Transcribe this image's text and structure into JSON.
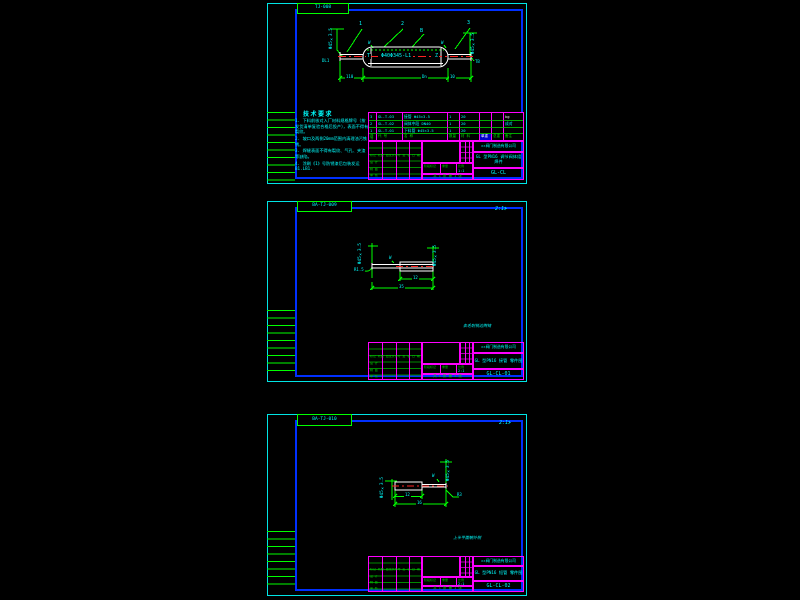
{
  "colors": {
    "background": "#000000",
    "border_outer_cyan": "#00e5e5",
    "border_inner_blue": "#0030ff",
    "frame_green": "#00ff00",
    "grid_magenta": "#ff00ff",
    "text_cyan": "#00ffff",
    "geometry_white": "#ffffff",
    "centerline_red": "#ff2222",
    "highlight_blue": "#0000cc"
  },
  "common": {
    "company": "××阀门制造有限公司",
    "mark_row": "标记 处数 更改文件号 签 名 日 期",
    "design_label": "设 计",
    "draft_label": "制 图",
    "check_label": "审 核",
    "stage_label": "阶段标记",
    "weight_label": "重量",
    "scale_label": "比例",
    "sheet_info": "共 1 张  第 1 张"
  },
  "sheet1": {
    "tab": "TJ-008",
    "drawing": {
      "balloon_1": "1",
      "balloon_2": "2",
      "balloon_3": "B",
      "balloon_4": "3",
      "left_pipe_note": "Φ45×3.5",
      "right_pipe_note": "Φ45×3.5",
      "weld_left": "W",
      "weld_right": "W",
      "end_left": "T",
      "end_right": "Z",
      "part_label": "Φ40Φ345-L1",
      "corner_left": "DL1",
      "corner_right": "TB",
      "dim_left": "110",
      "dim_mid": "Dn",
      "dim_right": "10"
    },
    "notes": {
      "title": "技术要求",
      "item_1": "1. 下料前核对入厂材料规格牌号（按发货清单复验合格后投产），表面不得有裂纹。",
      "item_2": "2. 坡口及两侧20mm范围内清理油污铁锈。",
      "item_3": "3. 焊缝表面不得有裂纹、气孔、夹渣等缺陷。",
      "item_4": "4. 涂刷《1》号防锈漆后包装发运 B1.LB1."
    },
    "bom": {
      "header": [
        "序号",
        "代 号",
        "名  称",
        "数量",
        "材 料",
        "单重",
        "总重",
        "备注"
      ],
      "rows": [
        [
          "3",
          "GL-T-03",
          "接管 Φ45×3.5",
          "1",
          "20",
          "",
          "",
          "kg"
        ],
        [
          "2",
          "GL-T-02",
          "阀体中段 DN40",
          "1",
          "20",
          "",
          "",
          "成对"
        ],
        [
          "1",
          "GL-T-01",
          "下料管 Φ45×3.5",
          "1",
          "20",
          "",
          "",
          ""
        ]
      ]
    },
    "titleblock": {
      "part_name": "调节阀",
      "title": "GL 型PN16 调节阀体组焊件",
      "dwg_no": "GL-CL",
      "scale_value": "1:1"
    }
  },
  "sheet2": {
    "tab": "BA-TJ-009",
    "view_label": "2:1≯",
    "caption": "去毛刺锐边倒钝",
    "drawing": {
      "left_pipe_note": "Φ45×3.5",
      "right_pipe_note": "Φ45×3.5",
      "weld": "W",
      "radius_label": "R1.5",
      "dim_top": "12",
      "dim_bottom": "35"
    },
    "titleblock": {
      "part_name": "接管",
      "title": "GL 型PN16 接管 零件图",
      "dwg_no": "GL-CL-01",
      "scale_value": "2:1"
    }
  },
  "sheet3": {
    "tab": "BA-TJ-010",
    "view_label": "2:1≯",
    "caption": "上半平面朝外侧",
    "drawing": {
      "left_pipe_note": "Φ45×3.5",
      "right_pipe_note": "Φ45×3.5",
      "weld": "W",
      "radius_label": "R3",
      "dim_top": "12",
      "dim_bottom": "16"
    },
    "titleblock": {
      "part_name": "短管",
      "title": "GL 型PN16 短管 零件图",
      "dwg_no": "GL-CL-02",
      "scale_value": "2:1"
    }
  }
}
